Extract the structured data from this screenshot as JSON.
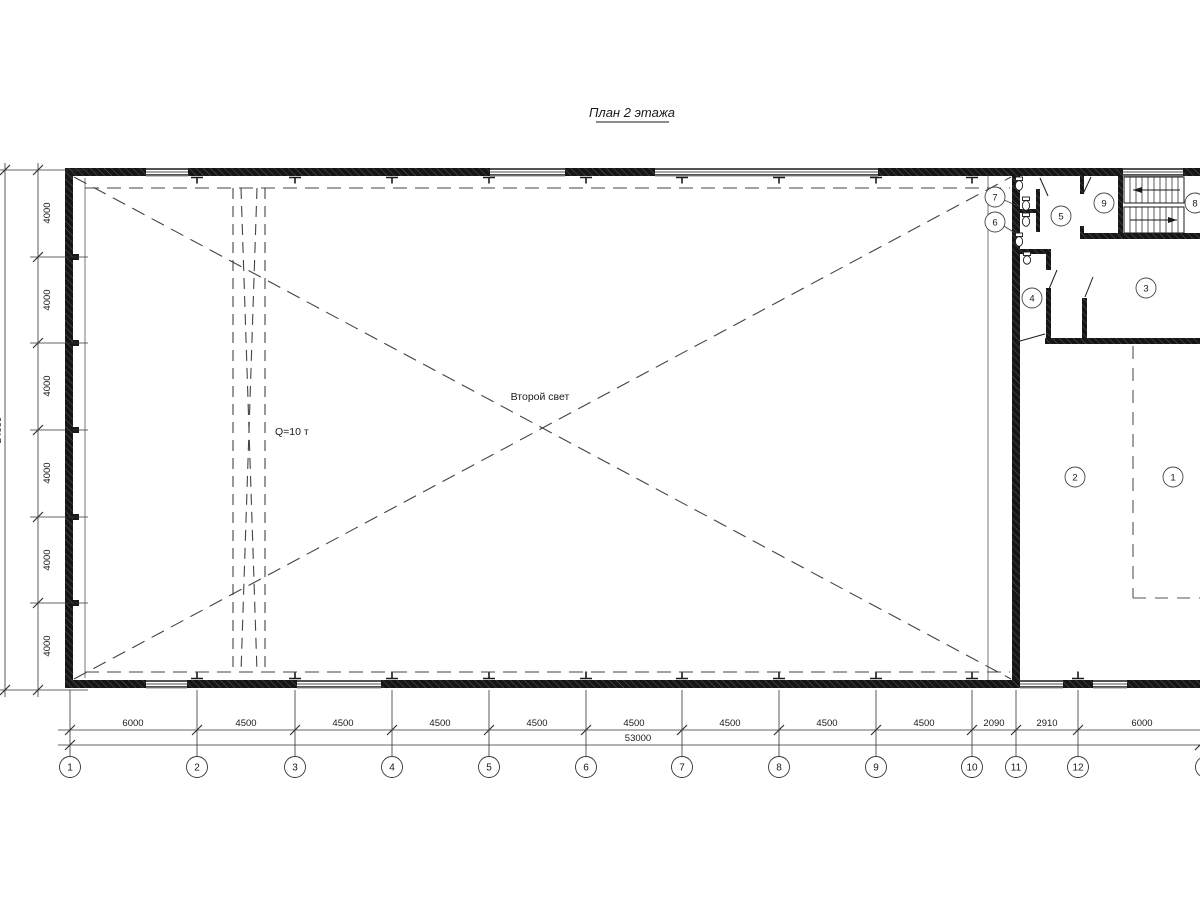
{
  "title": "План 2 этажа",
  "annotations": {
    "second_light": "Второй свет",
    "crane_capacity": "Q=10 т"
  },
  "dims_bottom": {
    "segments": [
      "6000",
      "4500",
      "4500",
      "4500",
      "4500",
      "4500",
      "4500",
      "4500",
      "4500",
      "2090",
      "2910",
      "6000"
    ],
    "total": "53000"
  },
  "dims_left": {
    "segments": [
      "4000",
      "4000",
      "4000",
      "4000",
      "4000",
      "4000"
    ],
    "total": "24000"
  },
  "axes_bottom": {
    "labels": [
      "1",
      "2",
      "3",
      "4",
      "5",
      "6",
      "7",
      "8",
      "9",
      "10",
      "11",
      "12",
      "13"
    ]
  },
  "rooms": {
    "labels": [
      "1",
      "2",
      "3",
      "4",
      "5",
      "6",
      "7",
      "8",
      "9"
    ]
  }
}
